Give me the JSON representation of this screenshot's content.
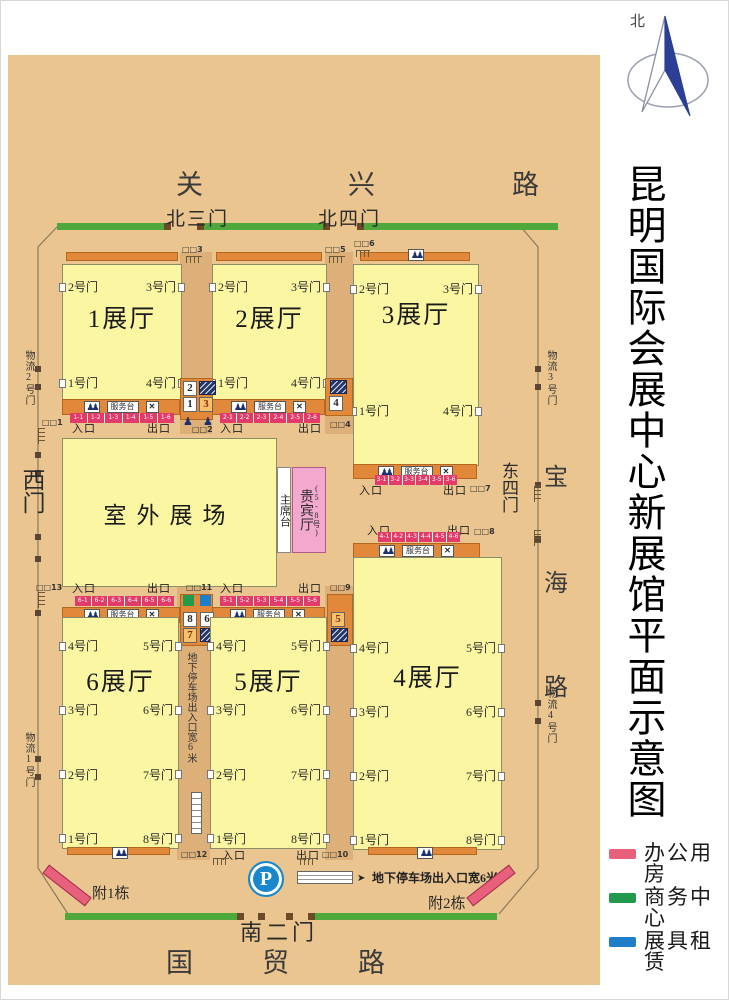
{
  "title": "昆明国际会展中心新展馆平面示意图",
  "compass": {
    "north_label": "北"
  },
  "legend": {
    "items": [
      {
        "label": "办公用房",
        "color": "#e8607c"
      },
      {
        "label": "商务中心",
        "color": "#229a4c"
      },
      {
        "label": "展具租赁",
        "color": "#1e7ec8"
      }
    ]
  },
  "roads": {
    "north": [
      "关",
      "兴",
      "路"
    ],
    "south": [
      "国",
      "贸",
      "路"
    ],
    "east": [
      "宝",
      "海",
      "路"
    ]
  },
  "outer_gates": {
    "north3": "北三门",
    "north4": "北四门",
    "west": "西门",
    "east4": "东四门",
    "south2": "南二门"
  },
  "logistics_gates": {
    "g1": "物流1号门",
    "g2": "物流2号门",
    "g3": "物流3号门",
    "g4": "物流4号门"
  },
  "annex": {
    "a1": "附1栋",
    "a2": "附2栋"
  },
  "labels": {
    "entrance": "入口",
    "exit": "出口",
    "service_desk": "服务台"
  },
  "outdoor_ground": "室外展场",
  "podium": "主席台",
  "vip_hall": {
    "label": "贵宾厅",
    "range": "(5-8号)"
  },
  "parking": {
    "symbol": "P",
    "note": "地下停车场出入口宽6米"
  },
  "gate_markers": {
    "m1": "□□1",
    "m2": "□□2",
    "m3": "□□3",
    "m4": "□□4",
    "m5": "□□5",
    "m6": "□□6",
    "m7": "□□7",
    "m8": "□□8",
    "m9": "□□9",
    "m10": "□□10",
    "m11": "□□11",
    "m12": "□□12",
    "m13": "□□13"
  },
  "room_boxes": {
    "b1": "1",
    "b2": "2",
    "b3": "3",
    "b4": "4",
    "b5": "5",
    "b6": "6",
    "b7": "7",
    "b8": "8"
  },
  "halls": {
    "h1": {
      "label": "1展厅",
      "doors_left": [
        "2号门",
        "1号门"
      ],
      "doors_right": [
        "3号门",
        "4号门"
      ],
      "windows": [
        "1-1",
        "1-2",
        "1-3",
        "1-4",
        "1-5",
        "1-6"
      ]
    },
    "h2": {
      "label": "2展厅",
      "doors_left": [
        "2号门",
        "1号门"
      ],
      "doors_right": [
        "3号门",
        "4号门"
      ],
      "windows": [
        "2-1",
        "2-2",
        "2-3",
        "2-4",
        "2-5",
        "2-6"
      ]
    },
    "h3": {
      "label": "3展厅",
      "doors_left": [
        "2号门",
        "1号门"
      ],
      "doors_right": [
        "3号门",
        "4号门"
      ],
      "windows": [
        "3-1",
        "3-2",
        "3-3",
        "3-4",
        "3-5",
        "3-6"
      ]
    },
    "h4": {
      "label": "4展厅",
      "doors_left": [
        "4号门",
        "3号门",
        "2号门",
        "1号门"
      ],
      "doors_right": [
        "5号门",
        "6号门",
        "7号门",
        "8号门"
      ],
      "windows": [
        "4-1",
        "4-2",
        "4-3",
        "4-4",
        "4-5",
        "4-6"
      ]
    },
    "h5": {
      "label": "5展厅",
      "doors_left": [
        "4号门",
        "3号门",
        "2号门",
        "1号门"
      ],
      "doors_right": [
        "5号门",
        "6号门",
        "7号门",
        "8号门"
      ],
      "windows": [
        "5-1",
        "5-2",
        "5-3",
        "5-4",
        "5-5",
        "5-6"
      ]
    },
    "h6": {
      "label": "6展厅",
      "doors_left": [
        "4号门",
        "3号门",
        "2号门",
        "1号门"
      ],
      "doors_right": [
        "5号门",
        "6号门",
        "7号门",
        "8号门"
      ],
      "windows": [
        "6-1",
        "6-2",
        "6-3",
        "6-4",
        "6-5",
        "6-6"
      ]
    }
  }
}
